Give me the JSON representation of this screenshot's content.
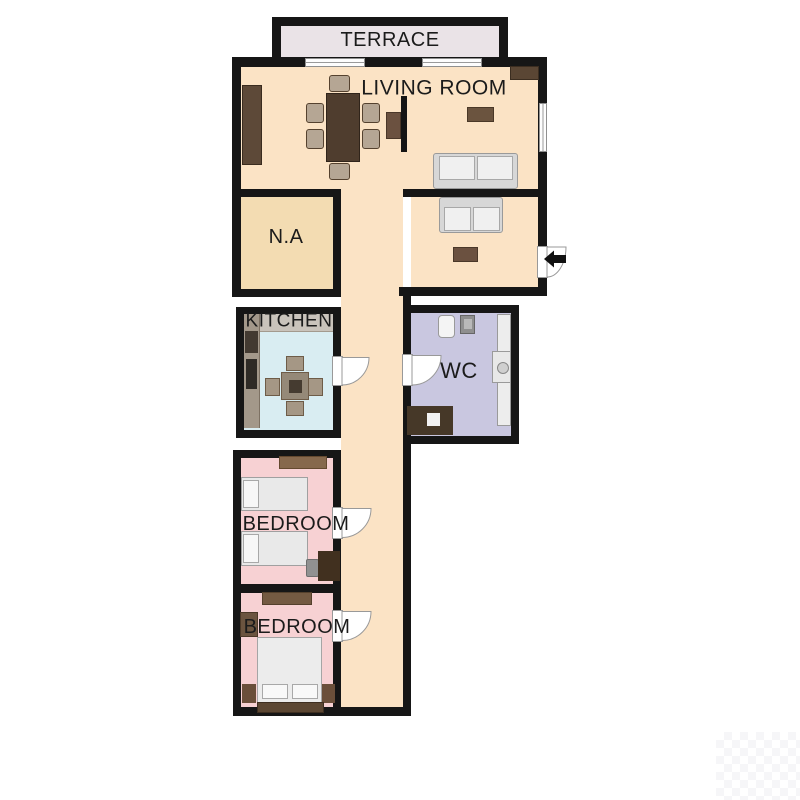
{
  "plan": {
    "type": "apartment-floor-plan",
    "rooms": {
      "terrace": {
        "label": "TERRACE",
        "floor_color": "#eae3e7"
      },
      "living_room span": {
        "label": "LIVING ROOM",
        "floor_color": "#fbe3c5"
      },
      "living_room": {
        "label": "LIVING ROOM",
        "floor_color": "#fbe3c5"
      },
      "na": {
        "label": "N.A",
        "floor_color": "#f3dcb2"
      },
      "kitchen": {
        "label": "KITCHEN",
        "floor_color": "#d9edf2"
      },
      "wc": {
        "label": "WC",
        "floor_color": "#c9c7e0"
      },
      "bedroom_1": {
        "label": "BEDROOM",
        "floor_color": "#f7d1d3"
      },
      "bedroom_2": {
        "label": "BEDROOM",
        "floor_color": "#f7d1d3"
      },
      "hallway": {
        "label": "",
        "floor_color": "#fbe3c5"
      }
    },
    "colors": {
      "wall": "#161616",
      "door_fill": "#ffffff",
      "door_stroke": "#999999",
      "label_text": "#1b1b1b",
      "wood_dark": "#4f3d2e",
      "wood_mid": "#6b543f",
      "sofa_fill": "#ededed"
    },
    "doors": {
      "count": 5,
      "entrance": {
        "side": "right-wall",
        "icon": "entrance-arrow-left"
      },
      "interior": [
        "kitchen-door",
        "wc-door",
        "bedroom-1-door",
        "bedroom-2-door"
      ]
    },
    "windows": {
      "count": 3,
      "positions": [
        "terrace-wall-left",
        "terrace-wall-right",
        "right-wall"
      ]
    },
    "furniture": {
      "living_room": [
        "sideboard",
        "dining-table",
        "dining-chairs-x6",
        "tv",
        "tv-cabinet",
        "wall-cabinet",
        "side-table",
        "sofa-large",
        "sofa-small",
        "coffee-table"
      ],
      "kitchen": [
        "counter",
        "oven",
        "fridge",
        "square-table",
        "chairs-x4"
      ],
      "wc": [
        "toilet",
        "sink",
        "bathtub",
        "washbasin",
        "cabinet-washer"
      ],
      "bedroom_1": [
        "shelf-rug",
        "single-bed-x2",
        "desk",
        "desk-chair"
      ],
      "bedroom_2": [
        "wardrobe",
        "dresser",
        "double-bed",
        "nightstand-x2"
      ]
    }
  }
}
